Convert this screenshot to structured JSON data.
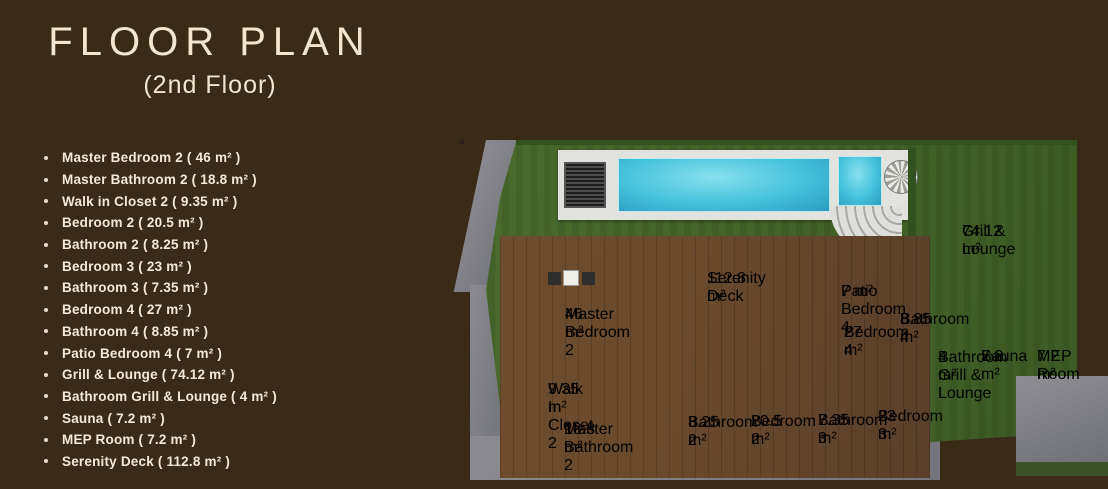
{
  "header": {
    "title": "FLOOR PLAN",
    "subtitle": "(2nd Floor)"
  },
  "room_list": [
    "Master Bedroom 2 ( 46 m² )",
    "Master Bathroom 2 ( 18.8 m² )",
    "Walk in Closet 2 ( 9.35 m² )",
    "Bedroom 2 ( 20.5 m² )",
    "Bathroom 2 ( 8.25 m² )",
    "Bedroom 3 ( 23 m² )",
    "Bathroom 3 ( 7.35 m² )",
    "Bedroom 4 ( 27 m² )",
    "Bathroom 4 ( 8.85 m² )",
    "Patio Bedroom 4 ( 7 m² )",
    "Grill & Lounge ( 74.12 m² )",
    "Bathroom Grill & Lounge ( 4 m² )",
    "Sauna ( 7.2 m² )",
    "MEP Room ( 7.2 m² )",
    "Serenity Deck ( 112.8 m² )"
  ],
  "plan": {
    "labels": {
      "serenity_deck": {
        "name": "Serenity Deck",
        "area": "112.8 m²"
      },
      "master_bedroom_2": {
        "name": "Master Bedroom 2",
        "area": "46 m²"
      },
      "walk_in_closet_2": {
        "name": "Walk In Closet 2",
        "area": "9.35 m²"
      },
      "master_bathroom_2": {
        "name": "Master Bathroom 2",
        "area": "18.8 m²"
      },
      "bathroom_2": {
        "name": "Bathroom 2",
        "area": "8.25 m²"
      },
      "bedroom_2": {
        "name": "Bedroom 2",
        "area": "20.5 m²"
      },
      "bathroom_3": {
        "name": "Bathroom 3",
        "area": "7.35 m²"
      },
      "bedroom_3": {
        "name": "Bedroom 3",
        "area": "23 m²"
      },
      "bedroom_4": {
        "name": "Bedroom 4",
        "area": "27 m²"
      },
      "patio_bedroom_4": {
        "name": "Patio Bedroom 4",
        "area": "7 m²"
      },
      "bathroom_4": {
        "name": "Bathroom 4",
        "area": "8.85 m²"
      },
      "bathroom_grill_lounge": {
        "name": "Bathroom Grill & Lounge",
        "area": "4 m²"
      },
      "sauna": {
        "name": "Sauna",
        "area": "7.2 m²"
      },
      "mep_room": {
        "name": "MEP Room",
        "area": "7.2 m²"
      },
      "grill_lounge": {
        "name": "Grill & Lounge",
        "area": "74.12 m²"
      }
    }
  },
  "colors": {
    "bg": "#3a2a18",
    "cream": "#f2e6d0",
    "pool": "#45c2dc",
    "grass": "#4a6b2c",
    "grass_dark": "#33511f",
    "wood": "#6b4a2c",
    "tile": "#c9c8c2",
    "pavement": "#82828a",
    "water": "#2a6f7a",
    "wall": "#2b231b",
    "pill": "rgba(24,19,14,0.8)"
  }
}
